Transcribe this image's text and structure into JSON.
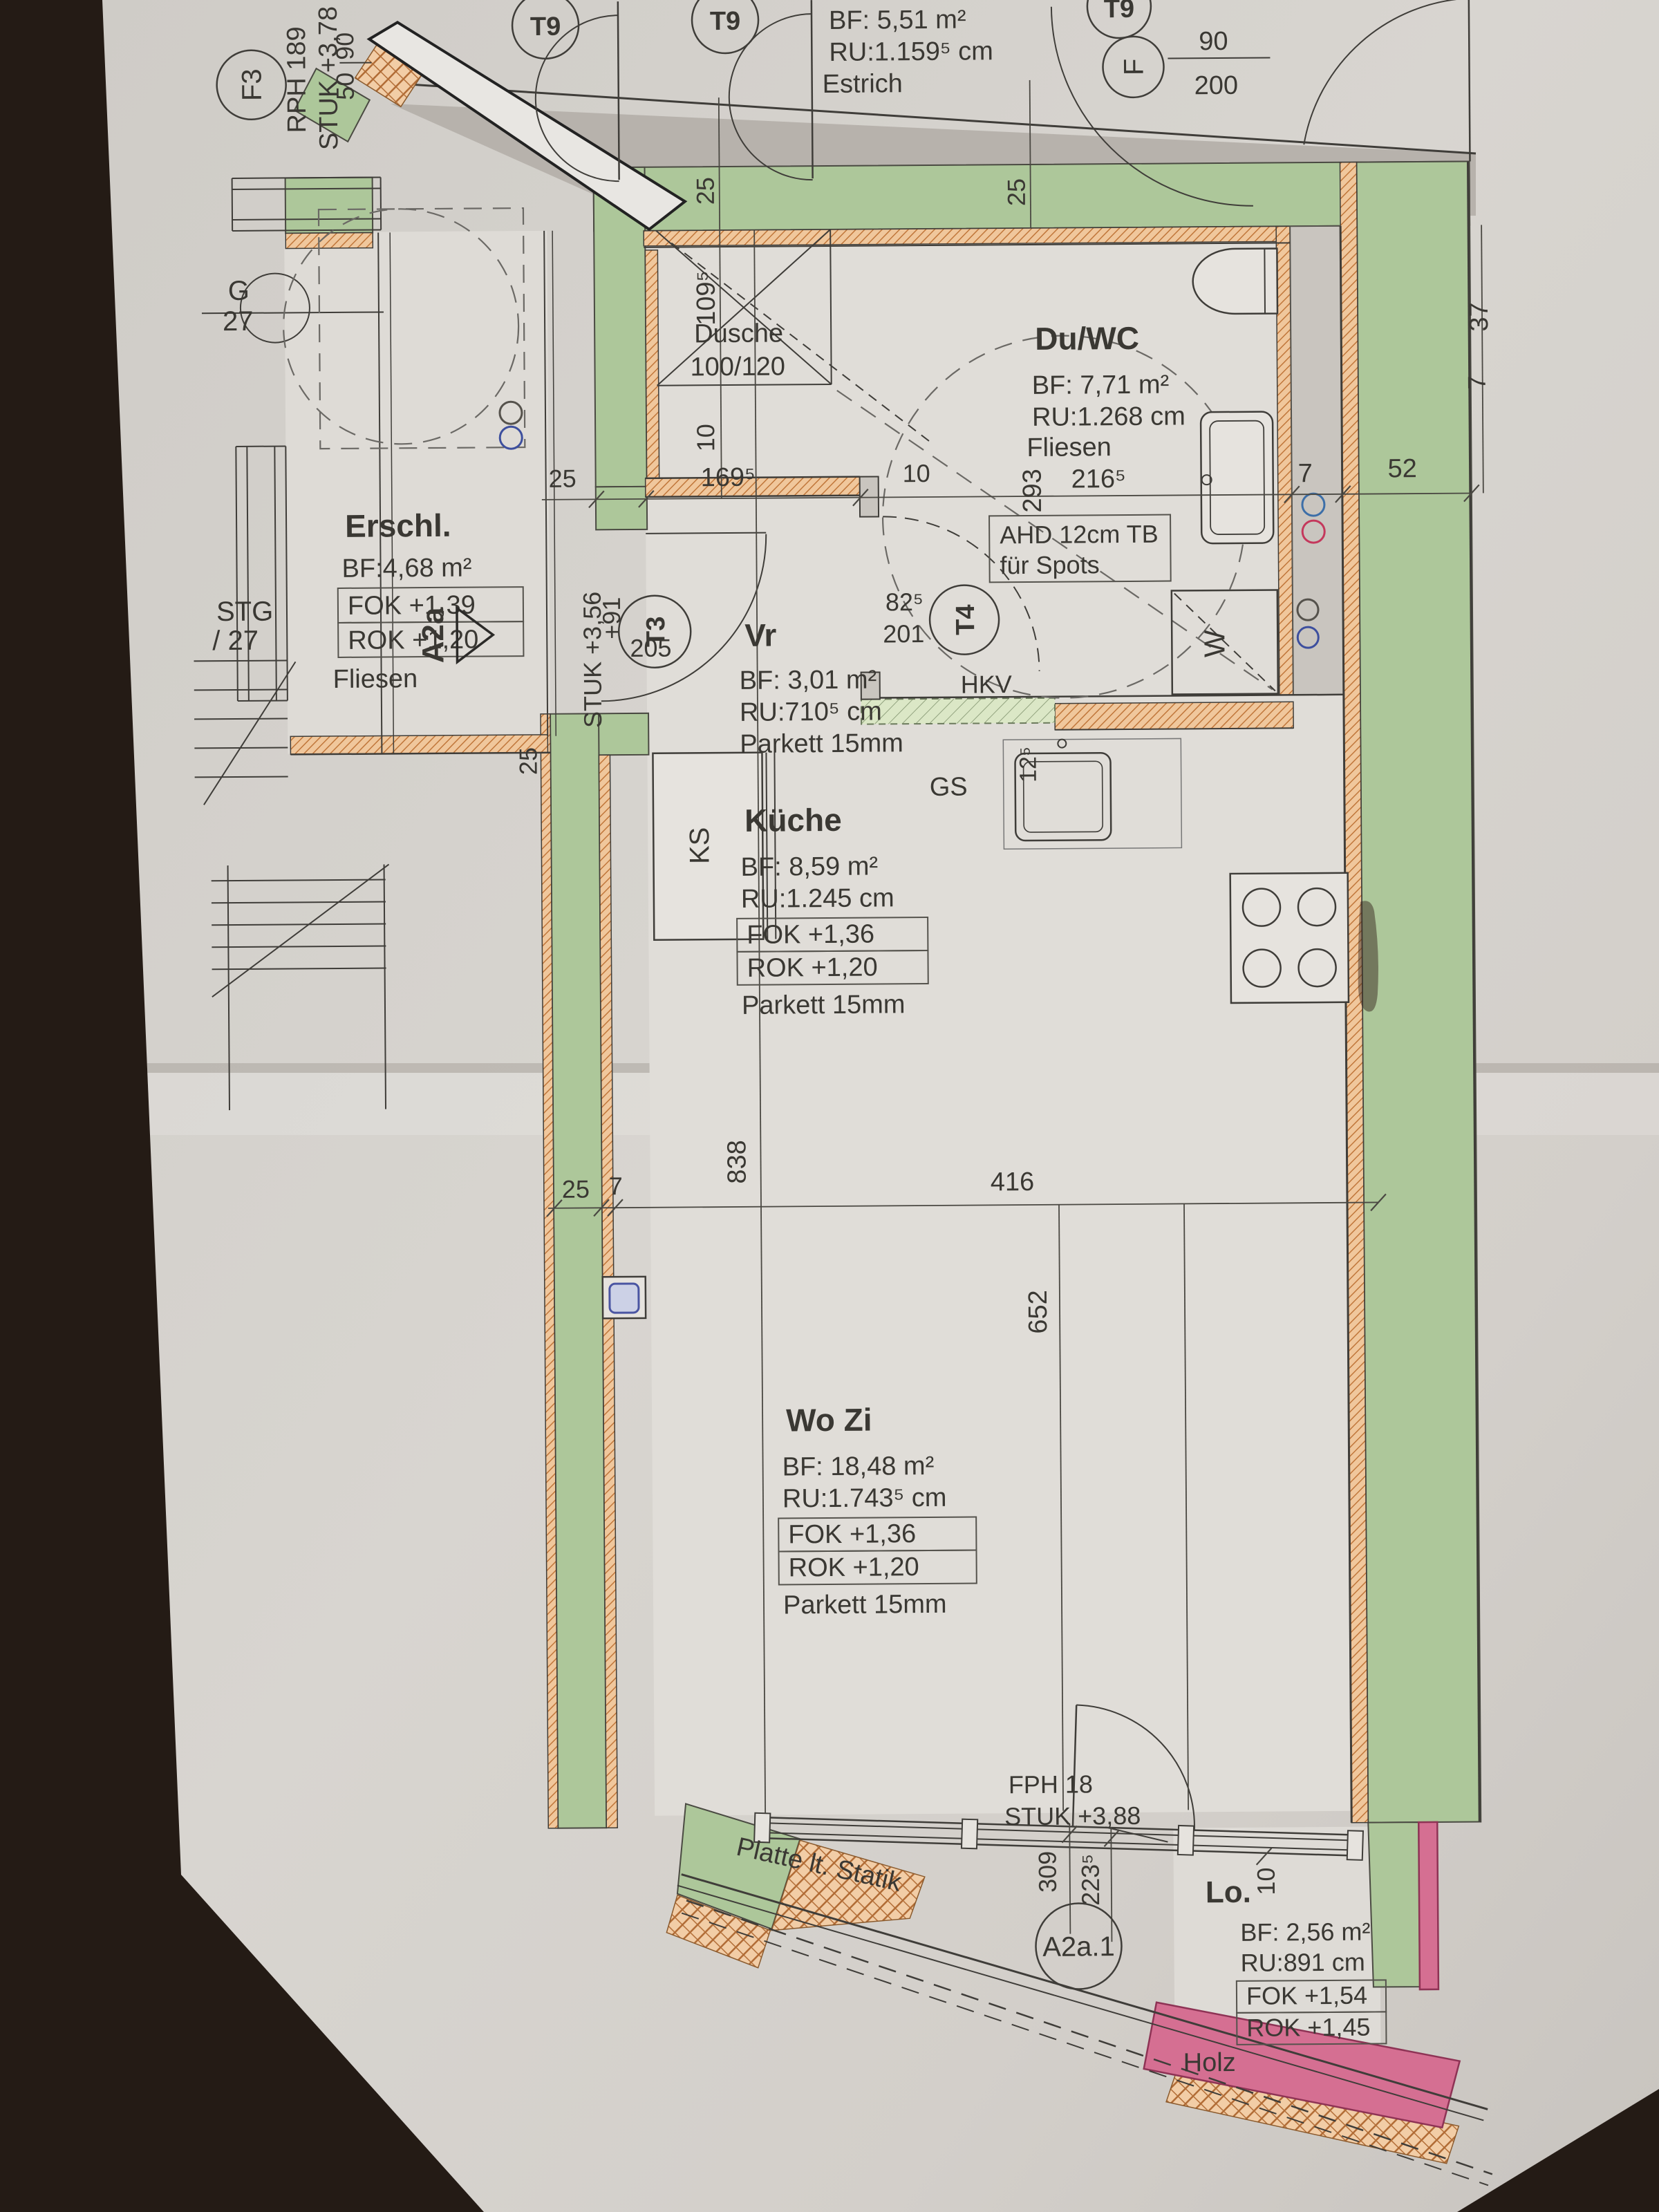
{
  "photo": {
    "background": "#241b15",
    "paper": "#d6d2cd",
    "gray_zone": "#b7b2ac"
  },
  "colors": {
    "wall_green": "#adc79a",
    "insulation_orange": "#f0c79c",
    "insulation_line": "#c0763a",
    "pink_wall": "#d56f92",
    "drywall_green": "#dbe7c6",
    "shaft_gray": "#c9c5bf",
    "line": "#3f3d39",
    "text": "#3a3833",
    "blue_symbol": "#3d4f9e",
    "red_symbol": "#c4385c"
  },
  "areas": {
    "stairwell": {
      "f3": "F3",
      "rph": "RPH 189",
      "stuk": "STUK +3,78",
      "w90": "90",
      "w50": "50",
      "g": "G",
      "g27": "27",
      "stg": "STG",
      "stg27": "/ 27"
    },
    "top_rooms": {
      "t9a": "T9",
      "t9b": "T9",
      "t9c": "T9",
      "bf": "BF:  5,51 m²",
      "ru": "RU:1.159⁵ cm",
      "floor": "Estrich",
      "f": "F",
      "d90": "90",
      "d200": "200"
    },
    "erschl": {
      "name": "Erschl.",
      "bf": "BF:4,68 m²",
      "fok": "FOK +1,39",
      "rok": "ROK +1,20",
      "floor": "Fliesen",
      "marker": "A2a"
    },
    "dusche": {
      "name": "Dusche",
      "size": "100/120",
      "d109": "109⁵",
      "d25a": "25",
      "d25b": "25",
      "d10": "10"
    },
    "duwc": {
      "name": "Du/WC",
      "bf": "BF:  7,71 m²",
      "ru": "RU:1.268 cm",
      "floor": "Fliesen",
      "d293": "293",
      "d216": "216⁵",
      "d7": "7",
      "d52": "52",
      "d37": "37",
      "d7b": "7",
      "ahd1": "AHD 12cm TB",
      "ahd2": "für Spots",
      "hkv": "HKV",
      "w": "W"
    },
    "vr": {
      "name": "Vr",
      "bf": "BF: 3,01 m²",
      "ru": "RU:710⁵ cm",
      "floor": "Parkett 15mm",
      "stuk": "STUK +3,56",
      "d91": "+91",
      "d205": "205",
      "t3": "T3",
      "d825": "82⁵",
      "d201": "201",
      "t4": "T4",
      "d25": "25",
      "d169": "169⁵",
      "d10": "10",
      "d25w": "25"
    },
    "kueche": {
      "name": "Küche",
      "bf": "BF:  8,59 m²",
      "ru": "RU:1.245 cm",
      "fok": "FOK    +1,36",
      "rok": "ROK    +1,20",
      "floor": "Parkett 15mm",
      "ks": "KS",
      "gs": "GS",
      "d125": "12⁵"
    },
    "wozi": {
      "name": "Wo Zi",
      "bf": "BF:  18,48 m²",
      "ru": "RU:1.743⁵ cm",
      "fok": "FOK    +1,36",
      "rok": "ROK    +1,20",
      "floor": "Parkett 15mm",
      "d838": "838",
      "d652": "652",
      "d25": "25",
      "d7": "7",
      "d416": "416"
    },
    "south": {
      "fph": "FPH 18",
      "stuk": "STUK +3,88",
      "d309": "309",
      "d223": "223⁵",
      "platte": "Platte lt. Statik",
      "a2a1": "A2a.1"
    },
    "lo": {
      "name": "Lo.",
      "bf": "BF: 2,56 m²",
      "ru": "RU:891 cm",
      "fok": "FOK +1,54",
      "rok": "ROK +1,45",
      "floor": "Holz",
      "d10": "10"
    }
  }
}
